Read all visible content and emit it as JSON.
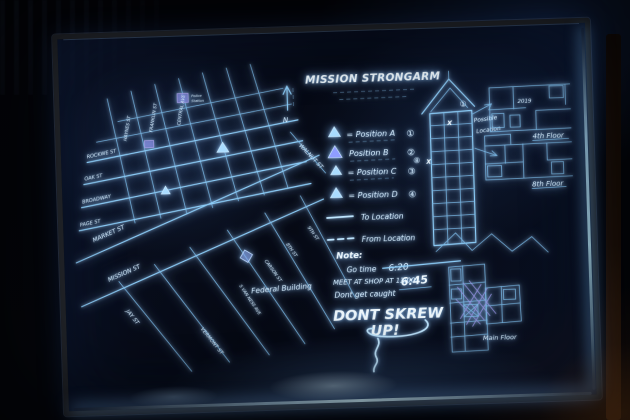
{
  "board": {
    "title": "MISSION STRONGARM"
  },
  "map": {
    "compass": "N",
    "streets": [
      {
        "name": "HAYNES ST"
      },
      {
        "name": "FRANKLIN ST"
      },
      {
        "name": "CENTRAL AVE"
      },
      {
        "name": "ROCKWE ST"
      },
      {
        "name": "OAK ST"
      },
      {
        "name": "BROADWAY"
      },
      {
        "name": "PAGE ST"
      },
      {
        "name": "MARKET ST"
      },
      {
        "name": "MISSION ST"
      },
      {
        "name": "JAY ST"
      },
      {
        "name": "VERMONT ST"
      },
      {
        "name": "S VAN NESS AVE"
      },
      {
        "name": "CARSON ST"
      },
      {
        "name": "8TH ST"
      },
      {
        "name": "9TH ST"
      },
      {
        "name": "WALNUT ST"
      }
    ],
    "federal_building": "Federal Building",
    "police_station_line1": "Police",
    "police_station_line2": "Station"
  },
  "legend": {
    "rows": [
      {
        "text": "= Position A",
        "badge": "①"
      },
      {
        "text": "Position B",
        "badge": "②"
      },
      {
        "text": "= Position C",
        "badge": "③"
      },
      {
        "text": "= Position D",
        "badge": "④"
      }
    ],
    "to_location": "To Location",
    "from_location": "From Location"
  },
  "notes": {
    "heading": "Note:",
    "go_time_label": "Go time",
    "go_time_old": "6:20",
    "go_time_new": "6:45",
    "meet": "MEET AT SHOP AT 13:00",
    "caution": "Dont get caught",
    "warning_line1": "DONT SKREW",
    "warning_line2": "UP!"
  },
  "building": {
    "annotation_line1": "Possible",
    "annotation_line2": "Location",
    "badge_top": "①",
    "badge_side": "⑧",
    "x_mark": "X"
  },
  "floor_plans": {
    "top_label": "4th Floor",
    "top_room": "2019",
    "mid_label": "8th Floor",
    "main_label": "Main Floor"
  },
  "colors": {
    "glow": "#8ccdf8",
    "glow_bright": "#f0faff",
    "accent_purple": "#8a7fd8"
  }
}
